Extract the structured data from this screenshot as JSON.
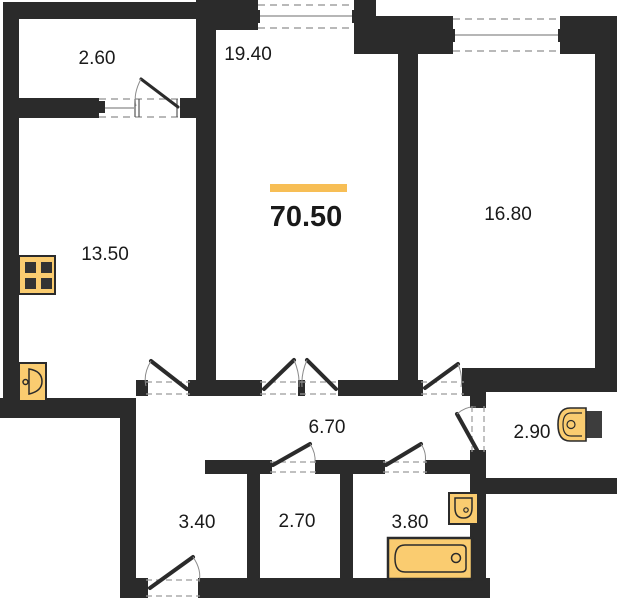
{
  "plan": {
    "title": "apartment floor plan",
    "total_area": "70.50",
    "rooms": [
      {
        "name": "balcony",
        "area": "2.60"
      },
      {
        "name": "living-room",
        "area": "19.40"
      },
      {
        "name": "bedroom",
        "area": "16.80"
      },
      {
        "name": "kitchen",
        "area": "13.50"
      },
      {
        "name": "corridor",
        "area": "6.70"
      },
      {
        "name": "wc",
        "area": "2.90"
      },
      {
        "name": "hallway",
        "area": "3.40"
      },
      {
        "name": "storage",
        "area": "2.70"
      },
      {
        "name": "bathroom",
        "area": "3.80"
      }
    ],
    "fixtures": [
      "stove-icon",
      "kitchen-sink-icon",
      "toilet-icon",
      "bathroom-sink-icon",
      "bathtub-icon"
    ],
    "colors": {
      "wall": "#2b2b2b",
      "fixture_fill": "#facc70",
      "accent": "#f7be55",
      "background": "#ffffff",
      "label_text": "#1a1a1a"
    }
  }
}
